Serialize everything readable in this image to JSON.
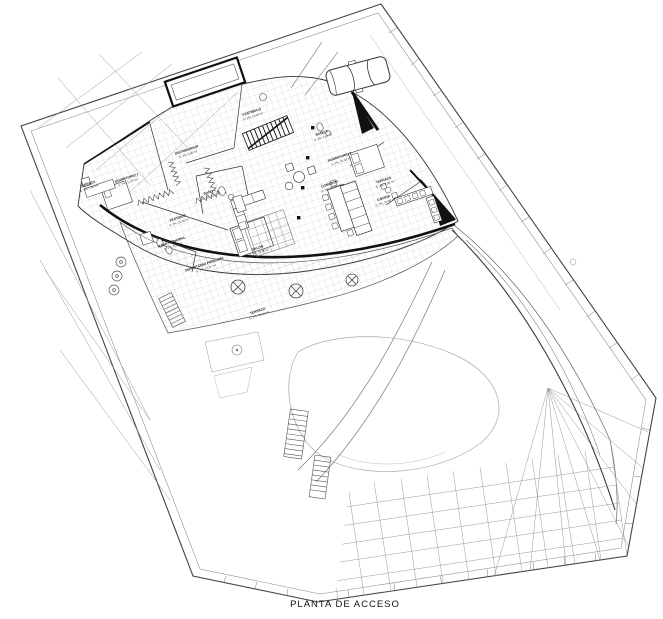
{
  "title": "PLANTA DE ACCESO",
  "rooms": [
    {
      "name": "VESTIBULO",
      "area": "S: 2%, 14,38 m²"
    },
    {
      "name": "DISTRIBUIDOR",
      "area": "S: 2%, 9,86 m²"
    },
    {
      "name": "DORMITORIO 1",
      "area": "S: 2%, 11,04 m²"
    },
    {
      "name": "TERRAZA",
      "area": "S: 2%, 7,46 m²"
    },
    {
      "name": "BAÑO 1",
      "area": "S: 2%, 5,67 m²"
    },
    {
      "name": "VESTIDOR",
      "area": "S: 2%, 10,46 m²"
    },
    {
      "name": "BAÑO PRINCIPAL",
      "area": "S: 2%, 4,27 m²"
    },
    {
      "name": "DORMITORIO PRINCIPAL",
      "area": "S: 2%, 13,87 m²"
    },
    {
      "name": "SALÓN",
      "area": "S: 2%, 19,86 m²"
    },
    {
      "name": "COMEDOR",
      "area": "S: 2%, 20,48 m²"
    },
    {
      "name": "COCINA",
      "area": "S: 2%, 16,08 m²"
    },
    {
      "name": "TERRAZA",
      "area": "S: 2%, 4,80 m²"
    },
    {
      "name": "DORMITORIO 2",
      "area": "S: 2%, 15,04 m²"
    },
    {
      "name": "BAÑO 2",
      "area": "S: 2%, 3,64 m²"
    },
    {
      "name": "TERRAZA",
      "area": "S: 2%, 45,84 m²"
    }
  ],
  "colors": {
    "ink": "#1a1a1a",
    "wall": "#111111",
    "line": "#555555",
    "grid": "#b5b5b5"
  }
}
